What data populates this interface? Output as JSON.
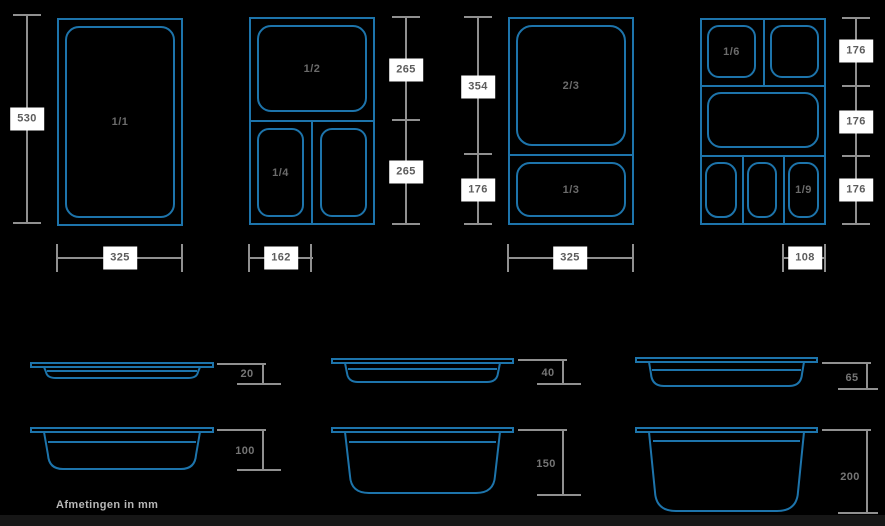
{
  "colors": {
    "background": "#000000",
    "container_line_blue": "#1d74ab",
    "dimension_line_gray": "#909090",
    "dimension_label_background": "#ffffff",
    "dimension_label_text": "#5c5c5c"
  },
  "footnote": "Afmetingen in mm",
  "top_views": [
    {
      "fractions": [
        "1/1"
      ],
      "heights": [
        "530"
      ],
      "width": "325"
    },
    {
      "fractions": [
        "1/2",
        "1/4"
      ],
      "heights": [
        "265",
        "265"
      ],
      "width": "162"
    },
    {
      "fractions": [
        "2/3",
        "1/3"
      ],
      "heights": [
        "354",
        "176"
      ],
      "width": "325"
    },
    {
      "fractions": [
        "1/6",
        "1/9"
      ],
      "heights": [
        "176",
        "176",
        "176"
      ],
      "width": "108"
    }
  ],
  "side_views": [
    {
      "depth": "20"
    },
    {
      "depth": "40"
    },
    {
      "depth": "65"
    },
    {
      "depth": "100"
    },
    {
      "depth": "150"
    },
    {
      "depth": "200"
    }
  ]
}
